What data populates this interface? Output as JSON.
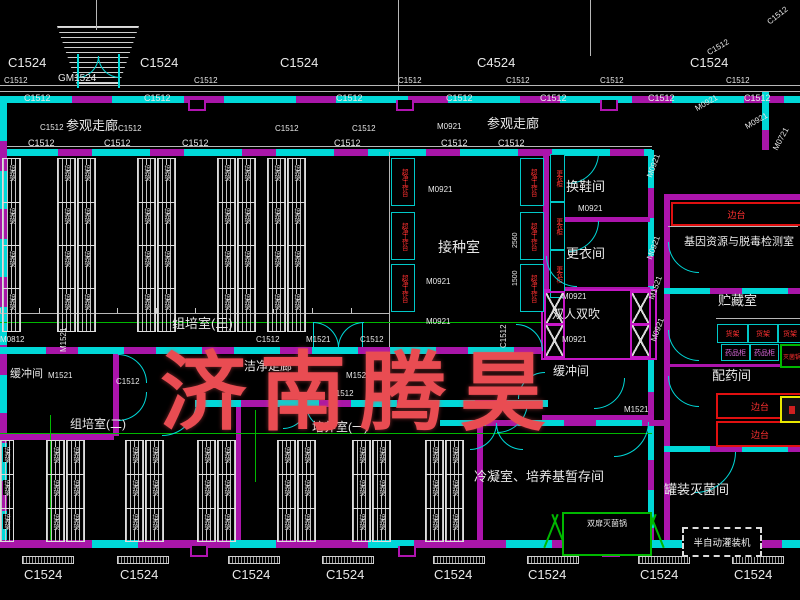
{
  "watermark": {
    "text": "济南腾昊",
    "color": "#e94c52"
  },
  "equipment": {
    "side_bench": "边台",
    "shelf": "货架",
    "medicine_cabinet": "药品柜",
    "small_sterilizer": "灭菌锅",
    "double_door_autoclave": "双扉灭菌锅",
    "semi_auto_filler": "半自动灌装机",
    "clean_bench": "超净工作台",
    "locker": "更衣柜",
    "culture_rack": "培养架"
  },
  "labels": [
    {
      "t": "C1524",
      "x": 8,
      "y": 56,
      "fs": 13
    },
    {
      "t": "C1524",
      "x": 140,
      "y": 56,
      "fs": 13
    },
    {
      "t": "C1524",
      "x": 280,
      "y": 56,
      "fs": 13
    },
    {
      "t": "C4524",
      "x": 477,
      "y": 56,
      "fs": 13
    },
    {
      "t": "C1524",
      "x": 690,
      "y": 56,
      "fs": 13
    },
    {
      "t": "GM1524",
      "x": 58,
      "y": 74,
      "fs": 10
    },
    {
      "t": "C1512",
      "x": 766,
      "y": 20,
      "fs": 8,
      "rot": -38
    },
    {
      "t": "C1512",
      "x": 706,
      "y": 50,
      "fs": 8,
      "rot": -30
    },
    {
      "t": "C1512",
      "x": 4,
      "y": 77,
      "fs": 8
    },
    {
      "t": "C1512",
      "x": 194,
      "y": 77,
      "fs": 8
    },
    {
      "t": "C1512",
      "x": 398,
      "y": 77,
      "fs": 8
    },
    {
      "t": "C1512",
      "x": 506,
      "y": 77,
      "fs": 8
    },
    {
      "t": "C1512",
      "x": 600,
      "y": 77,
      "fs": 8
    },
    {
      "t": "C1512",
      "x": 726,
      "y": 77,
      "fs": 8
    },
    {
      "t": "C1512",
      "x": 24,
      "y": 94,
      "fs": 9
    },
    {
      "t": "C1512",
      "x": 144,
      "y": 94,
      "fs": 9
    },
    {
      "t": "C1512",
      "x": 336,
      "y": 94,
      "fs": 9
    },
    {
      "t": "C1512",
      "x": 446,
      "y": 94,
      "fs": 9
    },
    {
      "t": "C1512",
      "x": 540,
      "y": 94,
      "fs": 9
    },
    {
      "t": "C1512",
      "x": 648,
      "y": 94,
      "fs": 9
    },
    {
      "t": "C1512",
      "x": 744,
      "y": 94,
      "fs": 9
    },
    {
      "t": "参观走廊",
      "x": 66,
      "y": 119,
      "fs": 13
    },
    {
      "t": "参观走廊",
      "x": 487,
      "y": 117,
      "fs": 13
    },
    {
      "t": "C1512",
      "x": 40,
      "y": 124,
      "fs": 8
    },
    {
      "t": "C1512",
      "x": 118,
      "y": 125,
      "fs": 8
    },
    {
      "t": "C1512",
      "x": 275,
      "y": 125,
      "fs": 8
    },
    {
      "t": "C1512",
      "x": 352,
      "y": 125,
      "fs": 8
    },
    {
      "t": "M0921",
      "x": 437,
      "y": 123,
      "fs": 8
    },
    {
      "t": "M0921",
      "x": 694,
      "y": 106,
      "fs": 8,
      "rot": -30
    },
    {
      "t": "M0921",
      "x": 744,
      "y": 124,
      "fs": 8,
      "rot": -30
    },
    {
      "t": "M0721",
      "x": 772,
      "y": 148,
      "fs": 8,
      "rot": -62
    },
    {
      "t": "C1512",
      "x": 28,
      "y": 139,
      "fs": 9
    },
    {
      "t": "C1512",
      "x": 104,
      "y": 139,
      "fs": 9
    },
    {
      "t": "C1512",
      "x": 182,
      "y": 139,
      "fs": 9
    },
    {
      "t": "C1512",
      "x": 334,
      "y": 139,
      "fs": 9
    },
    {
      "t": "C1512",
      "x": 441,
      "y": 139,
      "fs": 9
    },
    {
      "t": "C1512",
      "x": 498,
      "y": 139,
      "fs": 9
    },
    {
      "t": "M0921",
      "x": 428,
      "y": 186,
      "fs": 8
    },
    {
      "t": "M0921",
      "x": 426,
      "y": 278,
      "fs": 8
    },
    {
      "t": "M0921",
      "x": 426,
      "y": 318,
      "fs": 8
    },
    {
      "t": "接种室",
      "x": 438,
      "y": 240,
      "fs": 14
    },
    {
      "t": "换鞋间",
      "x": 566,
      "y": 180,
      "fs": 13
    },
    {
      "t": "M0921",
      "x": 578,
      "y": 205,
      "fs": 8
    },
    {
      "t": "更衣间",
      "x": 566,
      "y": 247,
      "fs": 13
    },
    {
      "t": "M0921",
      "x": 562,
      "y": 293,
      "fs": 8
    },
    {
      "t": "双人双吹",
      "x": 552,
      "y": 308,
      "fs": 12
    },
    {
      "t": "M0921",
      "x": 562,
      "y": 336,
      "fs": 8
    },
    {
      "t": "组培室(三)",
      "x": 172,
      "y": 317,
      "fs": 13
    },
    {
      "t": "C1512",
      "x": 256,
      "y": 336,
      "fs": 8
    },
    {
      "t": "M1521",
      "x": 306,
      "y": 336,
      "fs": 8
    },
    {
      "t": "C1512",
      "x": 360,
      "y": 336,
      "fs": 8
    },
    {
      "t": "M0812",
      "x": 0,
      "y": 336,
      "fs": 8
    },
    {
      "t": "缓冲间",
      "x": 10,
      "y": 369,
      "fs": 11
    },
    {
      "t": "M1521",
      "x": 48,
      "y": 372,
      "fs": 8
    },
    {
      "t": "M1521",
      "x": 60,
      "y": 352,
      "fs": 8,
      "rot": -90
    },
    {
      "t": "洁净走廊",
      "x": 244,
      "y": 360,
      "fs": 12
    },
    {
      "t": "M1521",
      "x": 346,
      "y": 372,
      "fs": 8
    },
    {
      "t": "C1512",
      "x": 330,
      "y": 390,
      "fs": 8
    },
    {
      "t": "C1512",
      "x": 116,
      "y": 378,
      "fs": 8
    },
    {
      "t": "缓冲间",
      "x": 553,
      "y": 365,
      "fs": 12
    },
    {
      "t": "C1512",
      "x": 500,
      "y": 348,
      "fs": 8,
      "rot": -90
    },
    {
      "t": "M1521",
      "x": 624,
      "y": 406,
      "fs": 8
    },
    {
      "t": "M0921",
      "x": 646,
      "y": 176,
      "fs": 8,
      "rot": -70
    },
    {
      "t": "M0921",
      "x": 646,
      "y": 258,
      "fs": 8,
      "rot": -70
    },
    {
      "t": "M1521",
      "x": 648,
      "y": 298,
      "fs": 8,
      "rot": -70
    },
    {
      "t": "M0921",
      "x": 650,
      "y": 340,
      "fs": 8,
      "rot": -70
    },
    {
      "t": "2560",
      "x": 512,
      "y": 248,
      "fs": 7,
      "rot": -90
    },
    {
      "t": "1500",
      "x": 512,
      "y": 286,
      "fs": 7,
      "rot": -90
    },
    {
      "t": "组培室(二)",
      "x": 70,
      "y": 418,
      "fs": 12
    },
    {
      "t": "培养室(一)",
      "x": 312,
      "y": 421,
      "fs": 12
    },
    {
      "t": "冷凝室、培养基暂存间",
      "x": 474,
      "y": 470,
      "fs": 13
    },
    {
      "t": "罐装灭菌间",
      "x": 664,
      "y": 483,
      "fs": 13
    },
    {
      "t": "基因资源与脱毒检测室",
      "x": 684,
      "y": 237,
      "fs": 11
    },
    {
      "t": "贮藏室",
      "x": 718,
      "y": 294,
      "fs": 13
    },
    {
      "t": "配药间",
      "x": 712,
      "y": 369,
      "fs": 13
    },
    {
      "t": "C1524",
      "x": 24,
      "y": 568,
      "fs": 13
    },
    {
      "t": "C1524",
      "x": 120,
      "y": 568,
      "fs": 13
    },
    {
      "t": "C1524",
      "x": 232,
      "y": 568,
      "fs": 13
    },
    {
      "t": "C1524",
      "x": 326,
      "y": 568,
      "fs": 13
    },
    {
      "t": "C1524",
      "x": 434,
      "y": 568,
      "fs": 13
    },
    {
      "t": "C1524",
      "x": 528,
      "y": 568,
      "fs": 13
    },
    {
      "t": "C1524",
      "x": 640,
      "y": 568,
      "fs": 13
    },
    {
      "t": "C1524",
      "x": 734,
      "y": 568,
      "fs": 13
    }
  ]
}
